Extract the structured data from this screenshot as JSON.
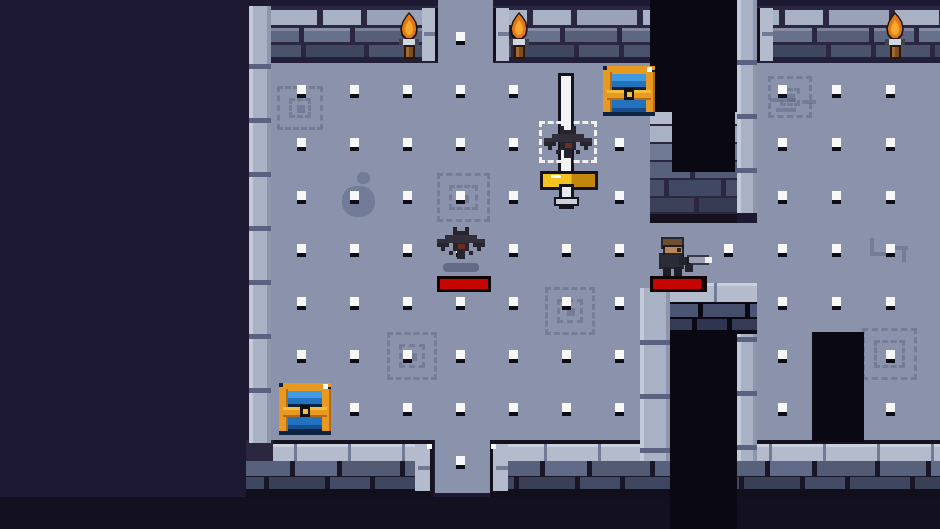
{
  "meta": {
    "app": "pixel-dungeon-room",
    "width": 940,
    "height": 529
  },
  "palette": {
    "void": "#1d1933",
    "void_bottom": "#131020",
    "floor": "#8a92ac",
    "dot_white": "#f8f8f8",
    "dot_shadow": "#0e0c16",
    "mortar": "#2b2743",
    "mortar_dark": "#191627",
    "brick_cap": "#a9b1c5",
    "brick_cap2": "#99a2b8",
    "brick_mid": "#5d6781",
    "brick_mid2": "#68718c",
    "brick_dark": "#4b526c",
    "brick_dark2": "#3f4660",
    "brick_low": "#58617c",
    "brick_low2": "#444b66",
    "wall_shadow": "#221f3a",
    "edge_dark": "#15121f",
    "band": "#b3bbcd",
    "band_joint": "#717b95",
    "band_top": "#c9cfdd",
    "column": "#a9b1c5",
    "column_hi": "#c3cad9",
    "column_lo": "#8d96ad",
    "column_joint": "#5a6280",
    "black": "#0a0913",
    "decal": "#5a6382",
    "health_red": "#c60500",
    "health_border": "#140505",
    "health_empty": "#1d0503",
    "chest_gold": "#e8991f",
    "chest_gold_dark": "#b56a12",
    "chest_gold_bright": "#f6bc3a",
    "chest_blue_light": "#3f9ae0",
    "chest_blue": "#2272c0",
    "chest_blue_dark": "#174e8e",
    "chest_navy": "#0d2342",
    "chest_black": "#10100c",
    "chest_glint": "#ffffff",
    "flame_outline": "#1a1208",
    "flame": "#e07916",
    "flame_core": "#f6a830",
    "torch_bracket": "#d3d7df",
    "torch_bracket_dark": "#3f434d",
    "torch_wood": "#7d4d22",
    "torch_wood_hi": "#a06a30",
    "torch_wood_dark": "#2a1708",
    "bat_body": "#26242e",
    "bat_hi": "#322f3b",
    "bat_chest": "#6d2d20",
    "bat_spawn_outline": "#f2f2f2",
    "shadow_blob": "rgba(30,34,64,0.35)",
    "sword_blade": "#f4f4f6",
    "sword_outline": "#15131e",
    "sword_guard_l": "#f2c321",
    "sword_guard_r": "#c2880e",
    "player_hair": "#6f4f2d",
    "player_face": "#b3885a",
    "player_eye": "#2e2218",
    "player_body": "#2c2c38",
    "player_dark": "#1e1e28",
    "gun_dark": "#23232d",
    "gun_barrel": "#9ba1b2",
    "gun_muzzle": "#f0f0f2"
  },
  "scene": {
    "floors": [
      {
        "x": 271,
        "y": 63,
        "w": 379,
        "h": 377
      },
      {
        "x": 438,
        "y": 0,
        "w": 55,
        "h": 63
      },
      {
        "x": 435,
        "y": 440,
        "w": 55,
        "h": 53
      },
      {
        "x": 650,
        "y": 223,
        "w": 290,
        "h": 60
      },
      {
        "x": 757,
        "y": 63,
        "w": 183,
        "h": 377
      }
    ],
    "dots": {
      "cols": [
        301,
        354,
        407,
        460,
        513,
        566,
        619,
        728,
        782,
        836,
        890
      ],
      "rows": [
        37,
        90,
        143,
        196,
        249,
        302,
        355,
        408,
        461
      ],
      "margin": 6
    },
    "top_walls": [
      {
        "x": 265,
        "w": 173,
        "capL": false,
        "capR": true,
        "ph": 0
      },
      {
        "x": 493,
        "w": 160,
        "capL": true,
        "capR": false,
        "ph": 18
      },
      {
        "x": 757,
        "w": 183,
        "capL": true,
        "capR": false,
        "ph": 30
      }
    ],
    "bottom_walls": [
      {
        "x": 246,
        "w": 187,
        "capL": false,
        "capR": true,
        "darkL": true,
        "ph": 6
      },
      {
        "x": 490,
        "w": 182,
        "capL": true,
        "capR": false,
        "ph": 0
      },
      {
        "x": 737,
        "w": 203,
        "capL": false,
        "capR": false,
        "ph": 22
      }
    ],
    "columns": [
      {
        "x": 249,
        "y": 6,
        "w": 22,
        "h": 437,
        "j0": 58,
        "name": "left-wall-column"
      },
      {
        "x": 737,
        "y": 0,
        "w": 20,
        "h": 213,
        "j0": 60,
        "name": "door-right-pillar"
      },
      {
        "x": 640,
        "y": 288,
        "w": 30,
        "h": 173,
        "j0": 52,
        "name": "passage-left-column"
      },
      {
        "x": 737,
        "y": 285,
        "w": 20,
        "h": 176,
        "j0": 52,
        "name": "passage-right-column"
      }
    ],
    "door_patch": {
      "x": 650,
      "y": 112,
      "w": 87,
      "h": 111
    },
    "passage_patch": {
      "x": 670,
      "y": 283,
      "w": 87,
      "h": 51
    },
    "black_rects": [
      {
        "x": 650,
        "y": 0,
        "w": 87,
        "h": 112,
        "name": "doorway-north",
        "inter": true
      },
      {
        "x": 672,
        "y": 112,
        "w": 63,
        "h": 60,
        "name": "doorway-north-inner",
        "inter": false
      },
      {
        "x": 670,
        "y": 330,
        "w": 67,
        "h": 199,
        "name": "passage-south",
        "inter": true
      },
      {
        "x": 812,
        "y": 332,
        "w": 52,
        "h": 110,
        "name": "doorway-alcove",
        "inter": true
      }
    ],
    "decals": [
      {
        "type": "spiral",
        "x": 437,
        "y": 173,
        "w": 53,
        "h": 49
      },
      {
        "type": "spiral",
        "x": 387,
        "y": 332,
        "w": 50,
        "h": 48
      },
      {
        "type": "spiral",
        "x": 545,
        "y": 287,
        "w": 50,
        "h": 48
      },
      {
        "type": "spiral",
        "x": 862,
        "y": 328,
        "w": 55,
        "h": 52
      },
      {
        "type": "spiral",
        "x": 768,
        "y": 76,
        "w": 44,
        "h": 42
      },
      {
        "type": "spiral",
        "x": 277,
        "y": 86,
        "w": 46,
        "h": 44
      },
      {
        "type": "blob",
        "x": 342,
        "y": 186,
        "w": 33,
        "h": 31
      },
      {
        "type": "blob",
        "x": 357,
        "y": 172,
        "w": 13,
        "h": 12
      },
      {
        "type": "dashes",
        "x": 770,
        "y": 98,
        "w": 48,
        "h": 16
      },
      {
        "type": "cracks",
        "x": 868,
        "y": 238,
        "w": 42,
        "h": 26
      }
    ],
    "torches": [
      {
        "x": 397,
        "y": 12
      },
      {
        "x": 507,
        "y": 12
      },
      {
        "x": 883,
        "y": 12
      }
    ],
    "chests": [
      {
        "x": 603,
        "y": 66,
        "w": 52,
        "h": 50,
        "name": "chest-top-right"
      },
      {
        "x": 279,
        "y": 383,
        "w": 52,
        "h": 52,
        "name": "chest-bottom-left"
      }
    ],
    "sword": {
      "blade_x": 561,
      "blade_y": 76,
      "blade_w": 10,
      "blade_h": 100,
      "guard_x": 543,
      "guard_y": 174,
      "guard_w": 52,
      "guard_h": 13,
      "grip_x": 562,
      "grip_y": 187,
      "grip_w": 9,
      "grip_h": 19
    },
    "bats": [
      {
        "x": 544,
        "y": 126,
        "spawn_outline": true,
        "name": "bat-enemy-spawning"
      },
      {
        "x": 437,
        "y": 227,
        "spawn_outline": false,
        "name": "bat-enemy",
        "shadow": {
          "x": 443,
          "y": 263,
          "w": 36,
          "h": 9
        }
      }
    ],
    "health_bars": [
      {
        "x": 437,
        "y": 276,
        "w": 54,
        "h": 16,
        "fill": 1.0,
        "name": "bat-health-bar"
      },
      {
        "x": 650,
        "y": 276,
        "w": 57,
        "h": 16,
        "fill": 0.94,
        "name": "player-health-bar"
      }
    ],
    "player": {
      "x": 655,
      "y": 236,
      "name": "player-character"
    }
  }
}
